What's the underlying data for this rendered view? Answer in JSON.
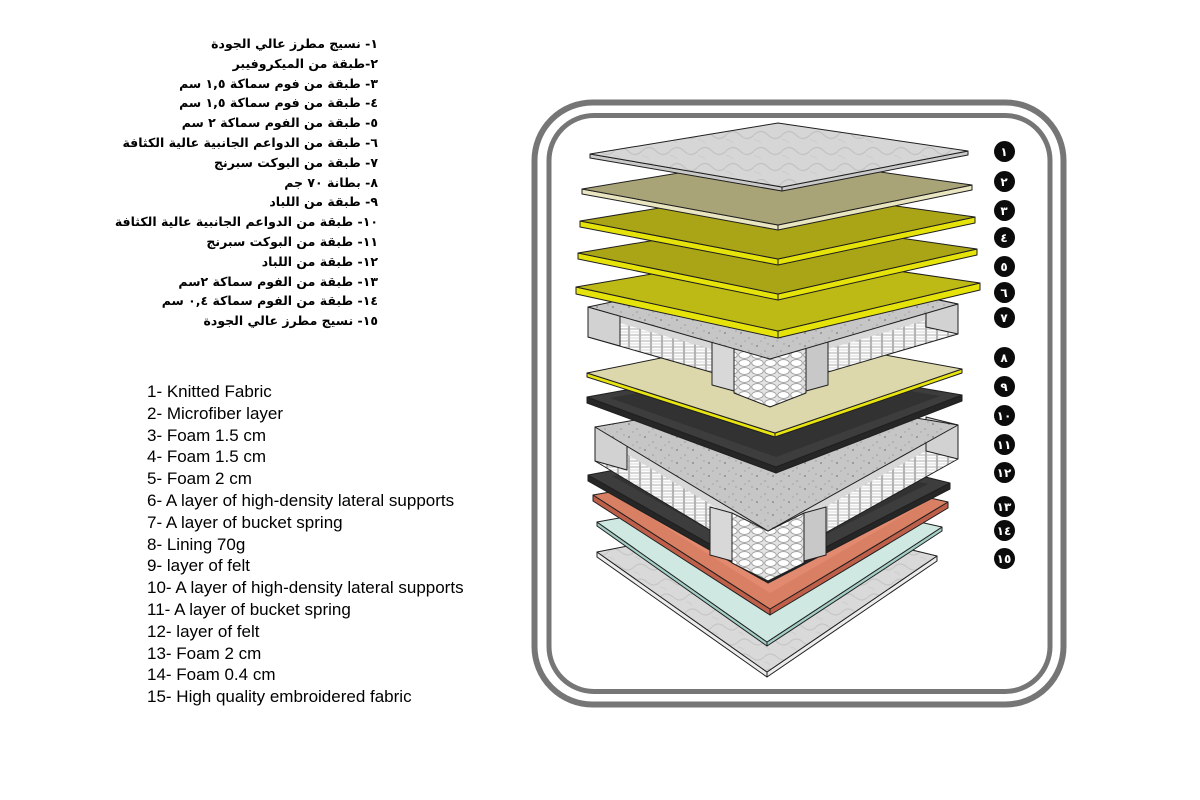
{
  "arabic_list": {
    "items": [
      "١- نسيج مطرز عالي الجودة",
      "٢-طبقة من الميكروفيبر",
      "٣- طبقة من فوم سماكة ١,٥ سم",
      "٤- طبقة من فوم سماكة ١,٥ سم",
      "٥- طبقة من الفوم سماكة ٢ سم",
      "٦- طبقة من الدواعم الجانبية عالية الكثافة",
      "٧- طبقة من البوكت سبرنج",
      "٨- بطانة ٧٠ جم",
      "٩- طبقة من اللباد",
      "١٠- طبقة من الدواعم الجانبية عالية الكثافة",
      "١١- طبقة من البوكت سبرنج",
      "١٢- طبقة من اللباد",
      "١٣- طبقة من الفوم سماكة ٢سم",
      "١٤- طبقة من الفوم سماكة ٠,٤ سم",
      "١٥- نسيج مطرز عالي الجودة"
    ]
  },
  "english_list": {
    "items": [
      "1- Knitted Fabric",
      "2- Microfiber layer",
      "3- Foam 1.5 cm",
      "4- Foam 1.5 cm",
      "5- Foam 2 cm",
      "6- A layer of high-density lateral supports",
      "7- A layer of bucket spring",
      "8- Lining 70g",
      "9- layer of felt",
      "10- A layer of high-density lateral supports",
      "11- A layer of bucket spring",
      "12- layer of felt",
      "13- Foam 2 cm",
      "14- Foam 0.4 cm",
      "15- High quality embroidered fabric"
    ]
  },
  "diagram": {
    "description": "Exploded isometric view of 15 mattress layers inside a double rounded-rectangle frame",
    "badges": [
      {
        "label": "١",
        "x": 474,
        "y": 46
      },
      {
        "label": "٢",
        "x": 474,
        "y": 76
      },
      {
        "label": "٣",
        "x": 474,
        "y": 105
      },
      {
        "label": "٤",
        "x": 474,
        "y": 132
      },
      {
        "label": "٥",
        "x": 474,
        "y": 161
      },
      {
        "label": "٦",
        "x": 474,
        "y": 187
      },
      {
        "label": "٧",
        "x": 474,
        "y": 212
      },
      {
        "label": "٨",
        "x": 474,
        "y": 252
      },
      {
        "label": "٩",
        "x": 474,
        "y": 281
      },
      {
        "label": "١٠",
        "x": 474,
        "y": 310
      },
      {
        "label": "١١",
        "x": 474,
        "y": 339
      },
      {
        "label": "١٢",
        "x": 474,
        "y": 367
      },
      {
        "label": "١٣",
        "x": 474,
        "y": 401
      },
      {
        "label": "١٤",
        "x": 474,
        "y": 425
      },
      {
        "label": "١٥",
        "x": 474,
        "y": 453
      }
    ]
  },
  "colors": {
    "background": "#ffffff",
    "frame": "#767676",
    "badge_bg": "#0b0b0b",
    "badge_text": "#ffffff",
    "outline": "#1f1f1f",
    "l1_edge": "#c9c9c9",
    "l2_top": "#a9a378",
    "l2_edge": "#e9e5c0",
    "l3_top": "#a9a516",
    "l3_edge": "#e6e30a",
    "l4_top": "#a9a516",
    "l4_edge": "#e6e30a",
    "l5_top": "#bdb915",
    "l5_edge": "#e6e30a",
    "l8_top": "#dcd8ac",
    "l8_edge": "#e8e411",
    "l9_top": "#3d3d3d",
    "l9_edge": "#262626",
    "l12_top": "#3d3d3d",
    "l12_edge": "#262626",
    "l13_top": "#d97f63",
    "l13_edge": "#bf5f49",
    "l14_top": "#cfe9e2",
    "l14_edge": "#a4cec6",
    "l15_edge": "#ececec",
    "slab_rail": "#d8d8d8",
    "slab_cap": "#d2d2d2"
  }
}
